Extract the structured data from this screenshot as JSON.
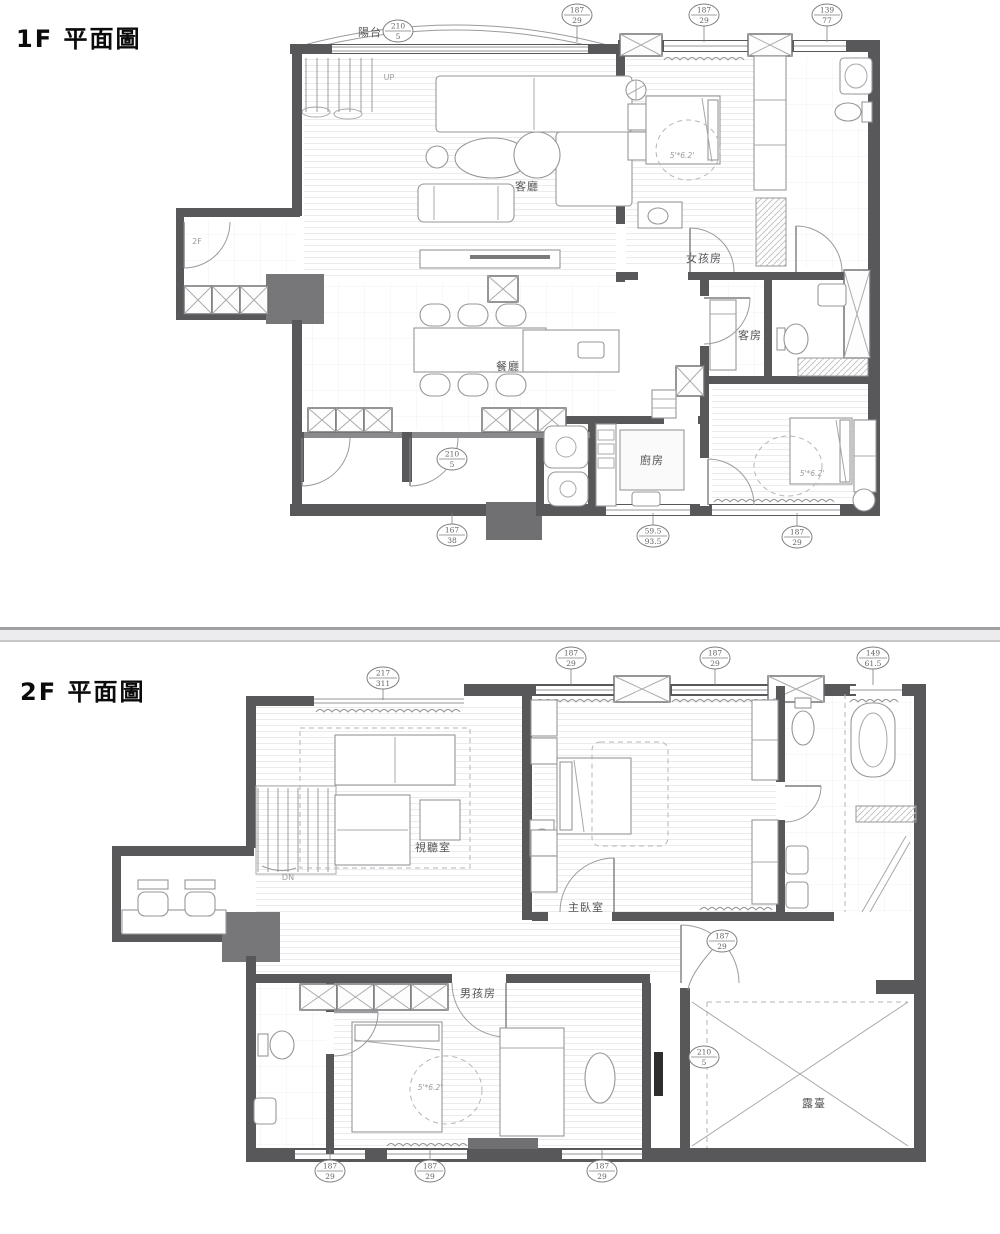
{
  "colors": {
    "wall": "#58585a",
    "wall_medium": "#707073",
    "furniture_line": "#97979a",
    "divider_band": "#ececee",
    "text": "#555558"
  },
  "floor1": {
    "title": "1F 平面圖",
    "labels": {
      "balcony": "陽台",
      "living": "客廳",
      "dining": "餐廳",
      "kitchen": "廚房",
      "girls_room": "女孩房",
      "guest_room": "客房",
      "stair_to_2f": "2F",
      "up": "UP",
      "bed_size_girls": "5'*6.2'",
      "bed_size_back": "5'*6.2'"
    },
    "bubbles": [
      {
        "t": "210",
        "b": "5"
      },
      {
        "t": "187",
        "b": "29"
      },
      {
        "t": "187",
        "b": "29"
      },
      {
        "t": "139",
        "b": "77"
      },
      {
        "t": "210",
        "b": "5"
      },
      {
        "t": "167",
        "b": "38"
      },
      {
        "t": "59.5",
        "b": "93.5"
      },
      {
        "t": "187",
        "b": "29"
      }
    ]
  },
  "floor2": {
    "title": "2F 平面圖",
    "labels": {
      "av_room": "視聽室",
      "master_room": "主臥室",
      "boys_room": "男孩房",
      "terrace": "露臺",
      "down": "DN",
      "bed_size_boys": "5'*6.2'"
    },
    "bubbles": [
      {
        "t": "217",
        "b": "311"
      },
      {
        "t": "187",
        "b": "29"
      },
      {
        "t": "187",
        "b": "29"
      },
      {
        "t": "149",
        "b": "61.5"
      },
      {
        "t": "187",
        "b": "29"
      },
      {
        "t": "210",
        "b": "5"
      },
      {
        "t": "187",
        "b": "29"
      },
      {
        "t": "187",
        "b": "29"
      },
      {
        "t": "187",
        "b": "29"
      }
    ]
  }
}
